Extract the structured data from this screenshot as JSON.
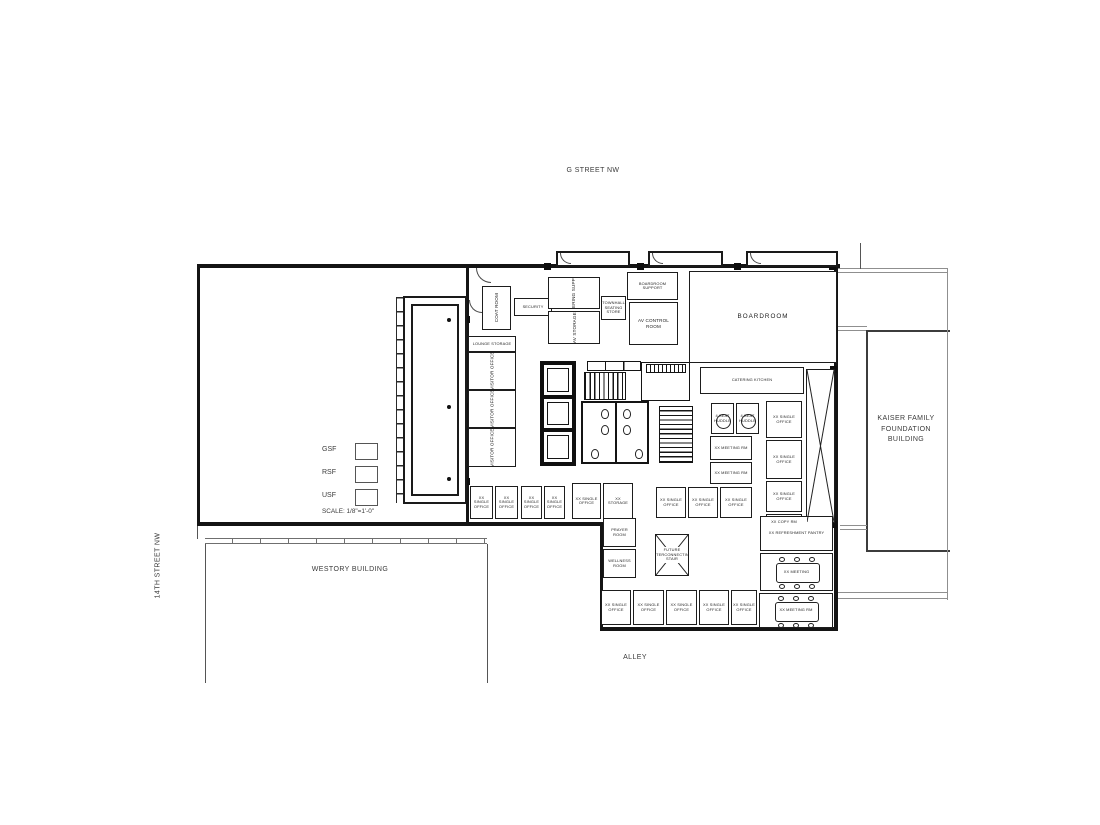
{
  "page": {
    "background": "#ffffff",
    "ink": "#141414",
    "context_line": "#8f8f8f",
    "text_color": "#3a3a3a"
  },
  "labels": {
    "g_street": "G STREET NW",
    "fourteenth_street": "14TH STREET NW",
    "westory": "WESTORY BUILDING",
    "alley": "ALLEY",
    "kaiser": "KAISER FAMILY\nFOUNDATION\nBUILDING"
  },
  "legend": {
    "items": [
      {
        "label": "GSF"
      },
      {
        "label": "RSF"
      },
      {
        "label": "USF"
      }
    ],
    "scale": "SCALE: 1/8\"=1'-0\""
  },
  "floorplan": {
    "rooms": [
      {
        "name": "coat-room",
        "x": 482,
        "y": 286,
        "w": 29,
        "h": 44,
        "label": "COAT ROOM",
        "orient": "v"
      },
      {
        "name": "security-desk",
        "x": 514,
        "y": 298,
        "w": 38,
        "h": 18,
        "label": "SECURITY",
        "small": true
      },
      {
        "name": "catering-support",
        "x": 548,
        "y": 277,
        "w": 52,
        "h": 32,
        "label": "CATERING SUPPORT",
        "orient": "v"
      },
      {
        "name": "av-storage",
        "x": 548,
        "y": 311,
        "w": 52,
        "h": 33,
        "label": "AV STORAGE",
        "orient": "v"
      },
      {
        "name": "seating-store",
        "x": 601,
        "y": 296,
        "w": 25,
        "h": 24,
        "label": "TOWNHALL SEATING STORE",
        "small": true
      },
      {
        "name": "boardroom-support",
        "x": 627,
        "y": 272,
        "w": 51,
        "h": 28,
        "label": "BOARDROOM SUPPORT",
        "small": true
      },
      {
        "name": "av-control-room",
        "x": 629,
        "y": 302,
        "w": 49,
        "h": 43,
        "label": "AV CONTROL ROOM"
      },
      {
        "name": "boardroom",
        "x": 689,
        "y": 271,
        "w": 148,
        "h": 92,
        "label": "BOARDROOM",
        "big": true
      },
      {
        "name": "catering-kitchen",
        "x": 700,
        "y": 367,
        "w": 104,
        "h": 27,
        "label": "CATERING KITCHEN",
        "small": true
      },
      {
        "name": "lounge-storage",
        "x": 468,
        "y": 336,
        "w": 48,
        "h": 16,
        "label": "LOUNGE STORAGE",
        "small": true
      },
      {
        "name": "visitor-office",
        "x": 468,
        "y": 352,
        "w": 48,
        "h": 38,
        "label": "VISITOR OFFICE",
        "orient": "v"
      },
      {
        "name": "visitor-office",
        "x": 468,
        "y": 390,
        "w": 48,
        "h": 38,
        "label": "VISITOR OFFICE",
        "orient": "v"
      },
      {
        "name": "visitor-office",
        "x": 468,
        "y": 428,
        "w": 48,
        "h": 39,
        "label": "VISITOR OFFICE",
        "orient": "v"
      },
      {
        "name": "single-office",
        "x": 470,
        "y": 486,
        "w": 23,
        "h": 33,
        "label": "XX SINGLE OFFICE",
        "small": true
      },
      {
        "name": "single-office",
        "x": 495,
        "y": 486,
        "w": 23,
        "h": 33,
        "label": "XX SINGLE OFFICE",
        "small": true
      },
      {
        "name": "single-office",
        "x": 521,
        "y": 486,
        "w": 21,
        "h": 33,
        "label": "XX SINGLE OFFICE",
        "small": true
      },
      {
        "name": "single-office",
        "x": 544,
        "y": 486,
        "w": 21,
        "h": 33,
        "label": "XX SINGLE OFFICE",
        "small": true
      },
      {
        "name": "single-office",
        "x": 572,
        "y": 483,
        "w": 29,
        "h": 36,
        "label": "XX SINGLE OFFICE",
        "small": true
      },
      {
        "name": "storage-room",
        "x": 603,
        "y": 483,
        "w": 30,
        "h": 36,
        "label": "XX STORAGE",
        "small": true
      },
      {
        "name": "single-office",
        "x": 656,
        "y": 487,
        "w": 30,
        "h": 31,
        "label": "XX SINGLE OFFICE",
        "small": true
      },
      {
        "name": "single-office",
        "x": 688,
        "y": 487,
        "w": 30,
        "h": 31,
        "label": "XX SINGLE OFFICE",
        "small": true
      },
      {
        "name": "single-office",
        "x": 720,
        "y": 487,
        "w": 32,
        "h": 31,
        "label": "XX SINGLE OFFICE",
        "small": true
      },
      {
        "name": "huddle-room",
        "x": 711,
        "y": 403,
        "w": 23,
        "h": 31,
        "label": "4 SEAT HUDDLE",
        "table": "round",
        "small": true
      },
      {
        "name": "huddle-room",
        "x": 736,
        "y": 403,
        "w": 23,
        "h": 31,
        "label": "4 SEAT HUDDLE",
        "table": "round",
        "small": true
      },
      {
        "name": "meeting-room",
        "x": 710,
        "y": 436,
        "w": 42,
        "h": 24,
        "label": "XX MEETING RM",
        "small": true
      },
      {
        "name": "meeting-room",
        "x": 710,
        "y": 462,
        "w": 42,
        "h": 22,
        "label": "XX MEETING RM",
        "small": true
      },
      {
        "name": "single-office",
        "x": 766,
        "y": 401,
        "w": 36,
        "h": 37,
        "label": "XX SINGLE OFFICE",
        "small": true
      },
      {
        "name": "single-office",
        "x": 766,
        "y": 440,
        "w": 36,
        "h": 39,
        "label": "XX SINGLE OFFICE",
        "small": true
      },
      {
        "name": "single-office",
        "x": 766,
        "y": 481,
        "w": 36,
        "h": 31,
        "label": "XX SINGLE OFFICE",
        "small": true
      },
      {
        "name": "copy-room",
        "x": 766,
        "y": 514,
        "w": 36,
        "h": 17,
        "label": "XX COPY RM",
        "small": true
      },
      {
        "name": "future-shaft",
        "x": 806,
        "y": 369,
        "w": 29,
        "h": 154,
        "cross": true,
        "label": ""
      },
      {
        "name": "prayer-room",
        "x": 603,
        "y": 518,
        "w": 33,
        "h": 29,
        "label": "PRAYER ROOM",
        "small": true
      },
      {
        "name": "wellness-room",
        "x": 603,
        "y": 549,
        "w": 33,
        "h": 29,
        "label": "WELLNESS ROOM",
        "small": true
      },
      {
        "name": "future-stair",
        "x": 655,
        "y": 534,
        "w": 34,
        "h": 42,
        "cross": true,
        "label": "FUTURE INTERCONNECTING STAIR",
        "small": true
      },
      {
        "name": "single-office",
        "x": 601,
        "y": 590,
        "w": 30,
        "h": 35,
        "label": "XX SINGLE OFFICE",
        "small": true
      },
      {
        "name": "single-office",
        "x": 633,
        "y": 590,
        "w": 31,
        "h": 35,
        "label": "XX SINGLE OFFICE",
        "small": true
      },
      {
        "name": "single-office",
        "x": 666,
        "y": 590,
        "w": 31,
        "h": 35,
        "label": "XX SINGLE OFFICE",
        "small": true
      },
      {
        "name": "single-office",
        "x": 699,
        "y": 590,
        "w": 30,
        "h": 35,
        "label": "XX SINGLE OFFICE",
        "small": true
      },
      {
        "name": "single-office",
        "x": 731,
        "y": 590,
        "w": 26,
        "h": 35,
        "label": "XX SINGLE OFFICE",
        "small": true
      },
      {
        "name": "refreshment-pantry",
        "x": 760,
        "y": 516,
        "w": 73,
        "h": 35,
        "label": "XX REFRESHMENT PANTRY",
        "small": true
      },
      {
        "name": "meeting-room",
        "x": 760,
        "y": 553,
        "w": 73,
        "h": 38,
        "label": "XX MEETING",
        "table": "rect",
        "small": true
      },
      {
        "name": "meeting-room",
        "x": 759,
        "y": 593,
        "w": 74,
        "h": 35,
        "label": "XX MEETING RM",
        "table": "rect",
        "small": true
      }
    ]
  }
}
